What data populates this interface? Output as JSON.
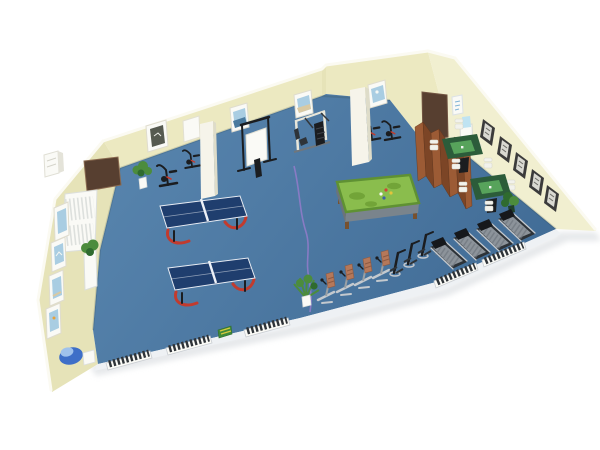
{
  "scene": {
    "title": "3D cutaway render of a recreation room with gym and game equipment",
    "room": {
      "label": "recreation-room",
      "view": "isometric cutaway",
      "background": "white",
      "floor": "blue",
      "walls": "cream"
    },
    "objects": [
      {
        "name": "ping-pong-table",
        "count": 2
      },
      {
        "name": "billiard-table",
        "count": 1
      },
      {
        "name": "mahjong-table",
        "count": 2
      },
      {
        "name": "mahjong-chair",
        "count": 8
      },
      {
        "name": "folding-screen-panel",
        "count": 7
      },
      {
        "name": "treadmill",
        "count": 4
      },
      {
        "name": "riding-exercise-machine",
        "count": 4
      },
      {
        "name": "stepper-machine",
        "count": 3
      },
      {
        "name": "exercise-bike",
        "count": 4
      },
      {
        "name": "multi-station-gym",
        "count": 1
      },
      {
        "name": "training-rack-with-board",
        "count": 1
      },
      {
        "name": "column",
        "count": 2
      },
      {
        "name": "door",
        "count": 2
      },
      {
        "name": "wall-picture-back",
        "count": 5
      },
      {
        "name": "wall-picture-left",
        "count": 4
      },
      {
        "name": "wall-picture-right",
        "count": 5
      },
      {
        "name": "radiator",
        "count": 1
      },
      {
        "name": "bench",
        "count": 5
      },
      {
        "name": "potted-plant",
        "count": 4
      },
      {
        "name": "water-dispenser",
        "count": 1
      },
      {
        "name": "drinking-fountain",
        "count": 1
      },
      {
        "name": "ac-unit",
        "count": 1
      },
      {
        "name": "floor-cable",
        "count": 1
      },
      {
        "name": "step-platform",
        "count": 1
      }
    ]
  },
  "colors": {
    "wall": "#ECE9C1",
    "wallLight": "#F1EFD0",
    "wallShade": "#E6E3B8",
    "wallEdge": "#FBFAF2",
    "floor1": "#5A87B0",
    "floor2": "#426D97",
    "cutStrip": "#EEF1F4",
    "shadow": "#D3D7DB",
    "door": "#573F30",
    "column": "#F6F4EA",
    "columnShade": "#DEDCC9",
    "white": "#FAFAF6",
    "frameDark": "#3B3B3B",
    "pictureBlue": "#A9CDE2",
    "pingpong": "#1F3E6E",
    "pingpongLine": "#EDF1F7",
    "accentRed": "#C23B2E",
    "poolCloth": "#8ABD4D",
    "poolClothDark": "#6B9E33",
    "poolBody": "#7A848C",
    "legBrown": "#77512F",
    "mahjongRim": "#2C5C3A",
    "mahjongFelt": "#57A35B",
    "chair": "#F2F2EC",
    "screenWood": "#9C5B35",
    "screenWoodDark": "#7C4526",
    "treadDark": "#2E3338",
    "treadBelt": "#8C939A",
    "console": "#16181B",
    "metal": "#C4C9CE",
    "riderSeat": "#B5785A",
    "plantGreen": "#4C8C3C",
    "plantDark": "#2F6B2F",
    "cable": "#8F7BC8",
    "fountain": "#3E6FC8",
    "fountainLight": "#9FC2EC",
    "bottleBlue": "#BFE3F2",
    "benchSlat": "#2E3338"
  }
}
